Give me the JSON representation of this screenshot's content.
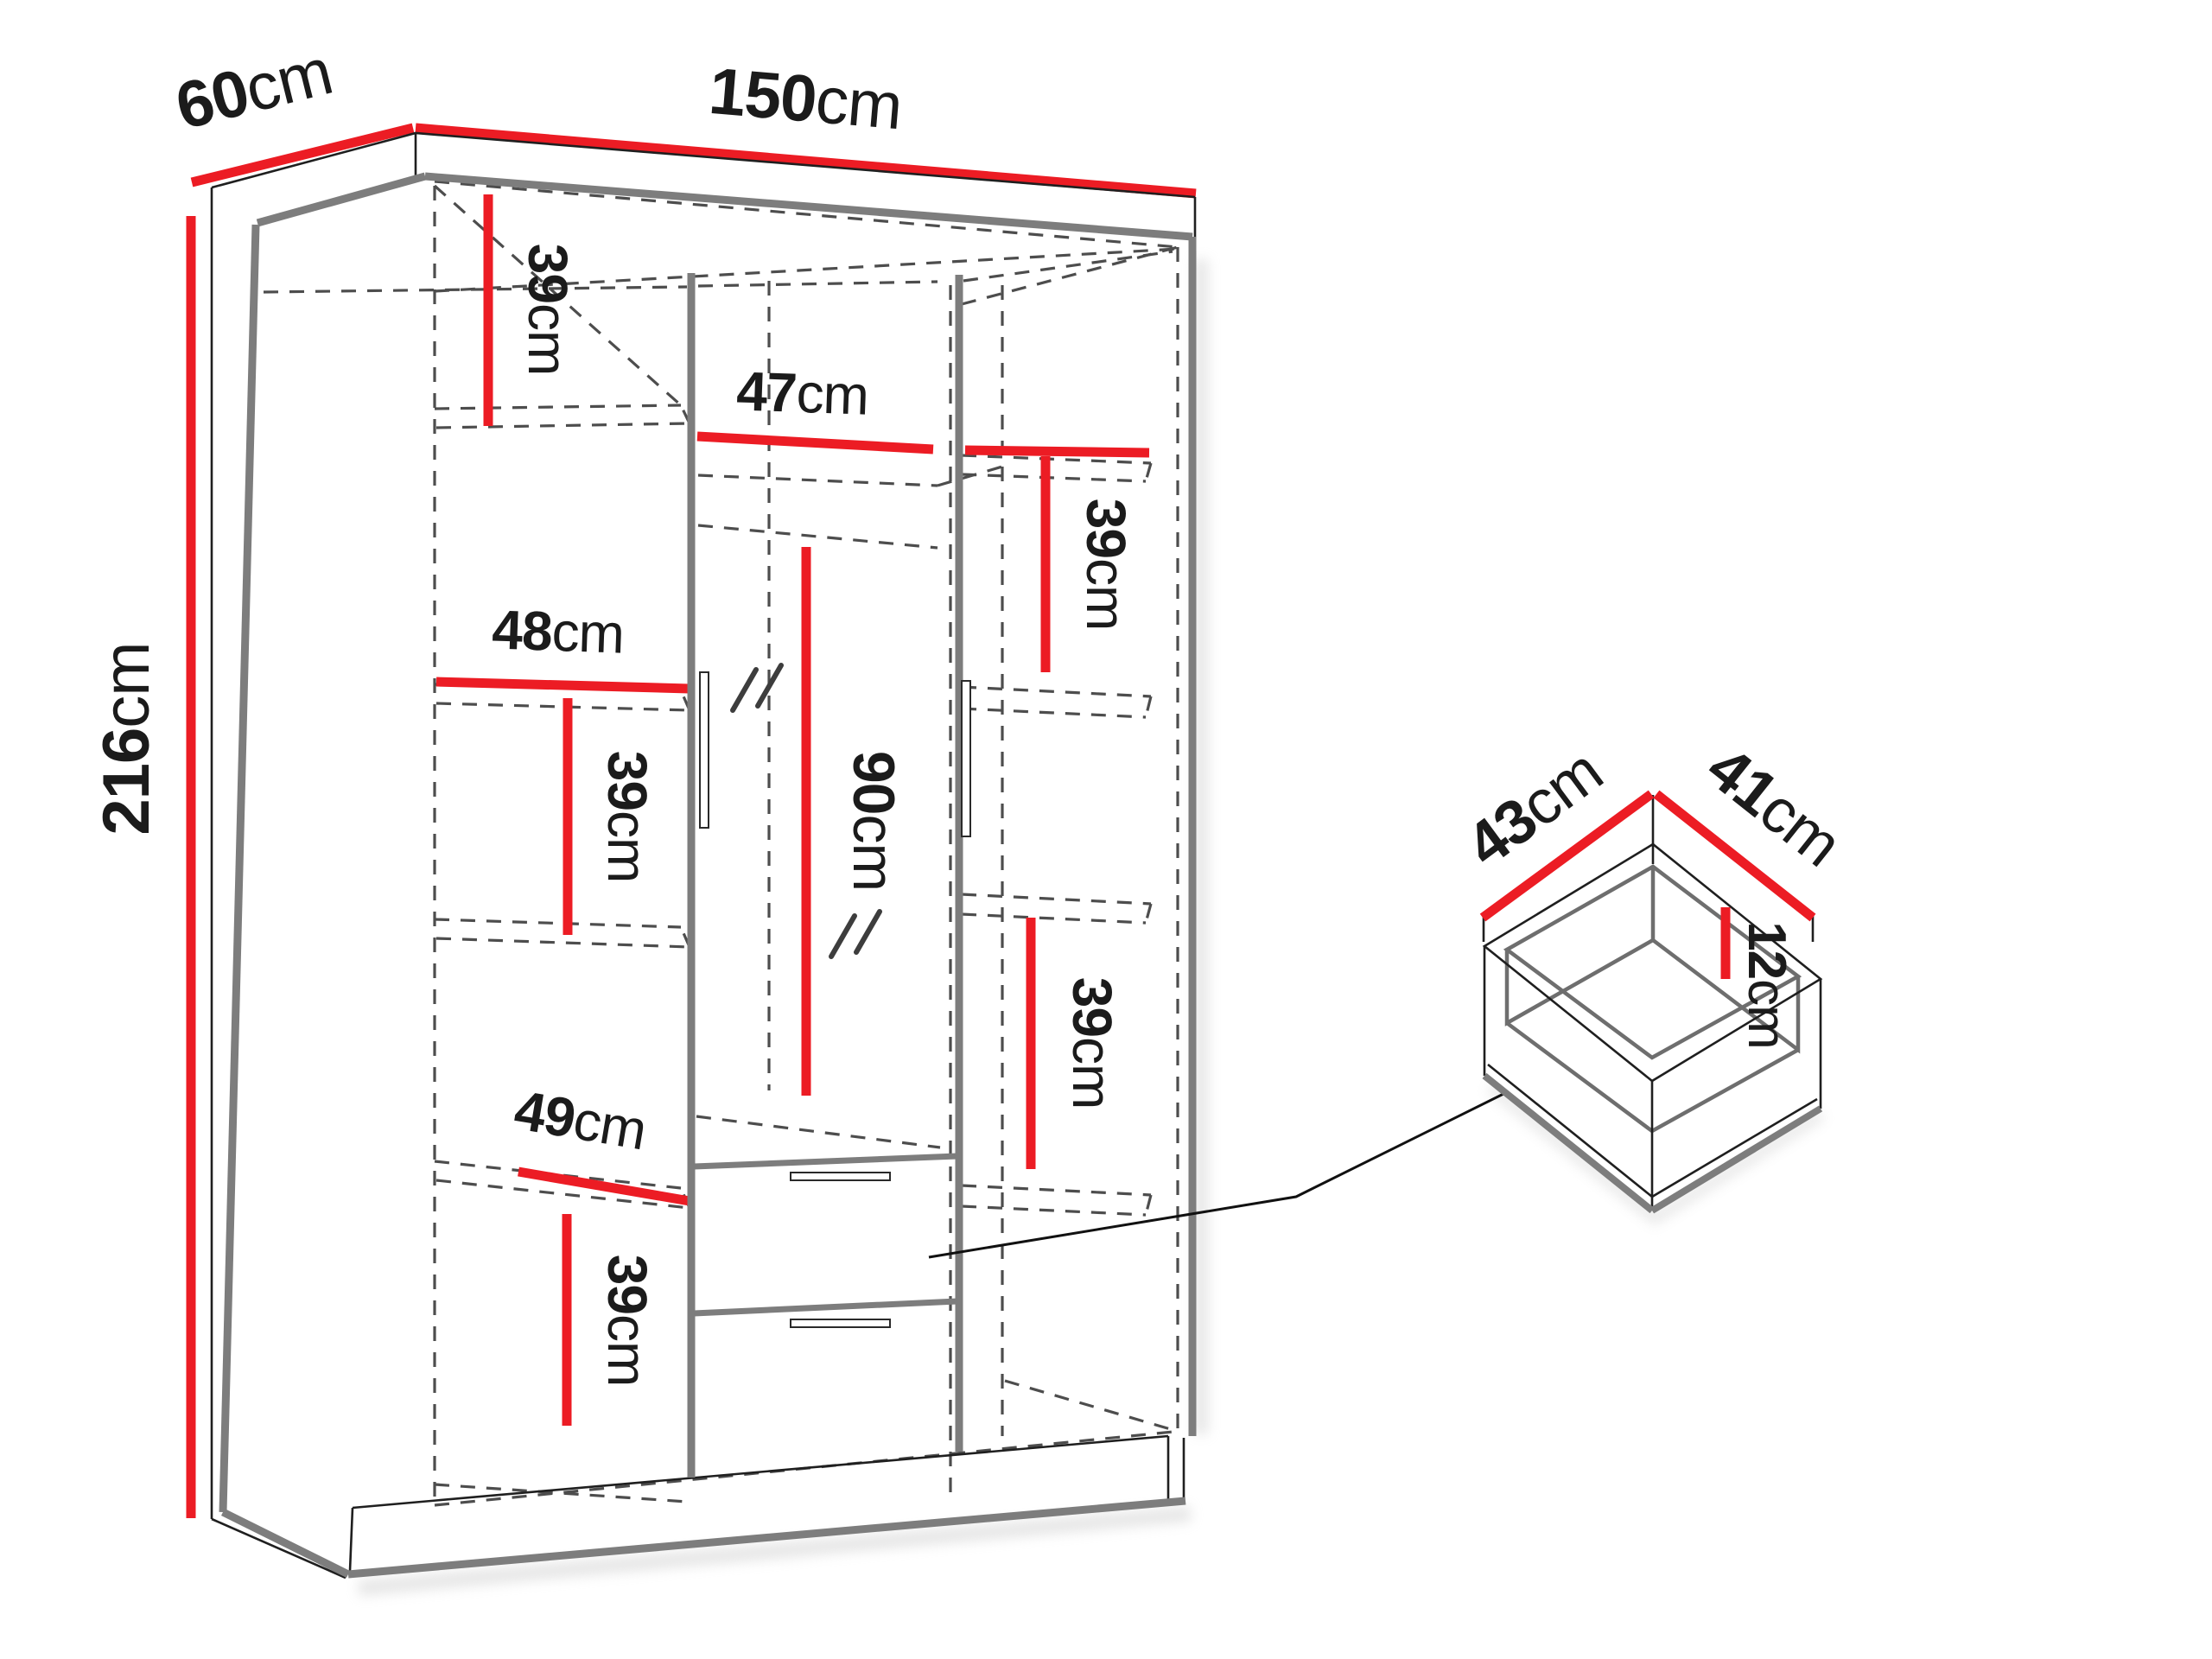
{
  "diagram": {
    "type": "furniture-dimension-diagram",
    "unit": "cm",
    "colors": {
      "dimension_line": "#ec1c24",
      "outline_thick": "#7d7d7d",
      "outline_thin": "#1f1f1f",
      "hidden_edge": "#4d4d4d",
      "label_text": "#1b1b1b",
      "background": "#ffffff"
    },
    "dims": {
      "depth": {
        "v": "60",
        "u": "cm"
      },
      "width": {
        "v": "150",
        "u": "cm"
      },
      "height": {
        "v": "216",
        "u": "cm"
      },
      "left_top_shelf": {
        "v": "39",
        "u": "cm"
      },
      "middle_width": {
        "v": "47",
        "u": "cm"
      },
      "left_width": {
        "v": "48",
        "u": "cm"
      },
      "left_mid_shelf": {
        "v": "39",
        "u": "cm"
      },
      "mirror_height": {
        "v": "90",
        "u": "cm"
      },
      "right_top_shelf": {
        "v": "39",
        "u": "cm"
      },
      "left_bottom_diag": {
        "v": "49",
        "u": "cm"
      },
      "left_bottom_shelf": {
        "v": "39",
        "u": "cm"
      },
      "right_bottom_shelf": {
        "v": "39",
        "u": "cm"
      },
      "drawer_depth": {
        "v": "43",
        "u": "cm"
      },
      "drawer_width": {
        "v": "41",
        "u": "cm"
      },
      "drawer_height": {
        "v": "12",
        "u": "cm"
      }
    }
  }
}
